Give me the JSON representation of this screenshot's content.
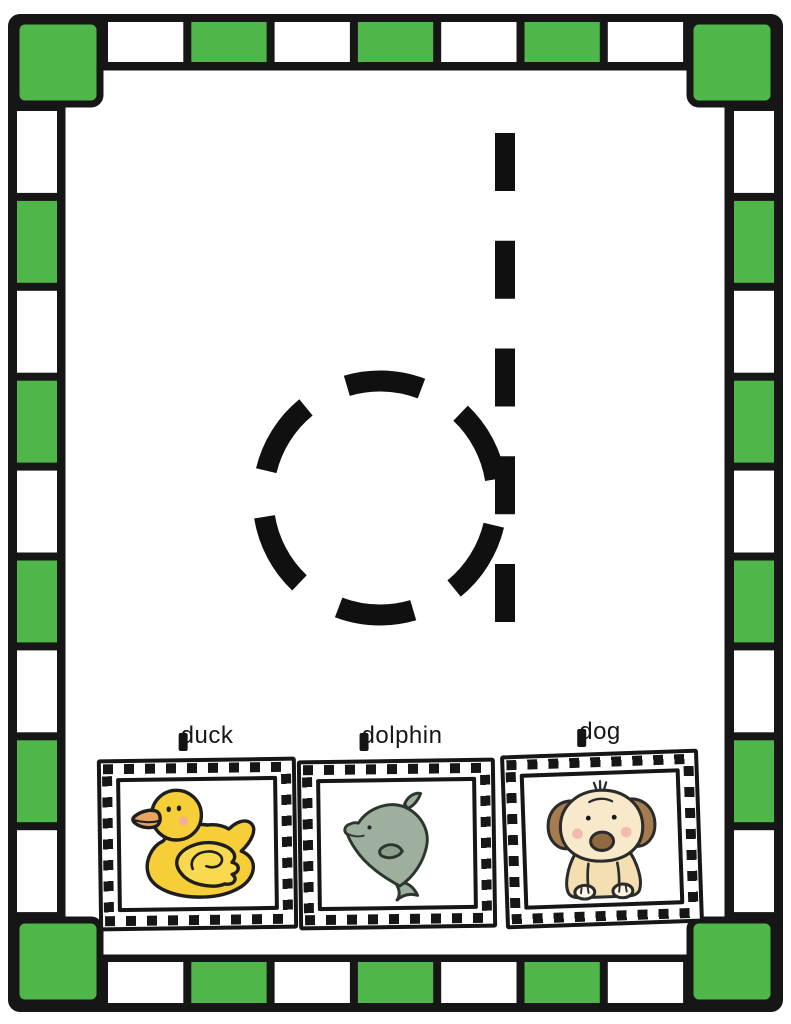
{
  "worksheet": {
    "letter": "d",
    "letter_case": "lowercase",
    "letter_style": "dashed-trace"
  },
  "colors": {
    "border_green": "#4fb74a",
    "border_white": "#ffffff",
    "frame_black": "#161616",
    "letter_black": "#101010",
    "duck_yellow": "#f6ce37",
    "duck_wing_yellow": "#f8d94f",
    "duck_bill_orange": "#e8a560",
    "dolphin_gray_green": "#9eb09d",
    "dolphin_fin": "#8ba18a",
    "dog_cream": "#f8e9ca",
    "dog_body_cream": "#f4dfb2",
    "dog_ear_brown": "#a47c50",
    "dog_nose_brown": "#8f6940",
    "dog_paw_cream": "#fcf4e3",
    "cheek_pink": "#f2aaa5"
  },
  "cards": [
    {
      "label": "duck",
      "image": "yellow-rubber-duck"
    },
    {
      "label": "dolphin",
      "image": "gray-green-dolphin"
    },
    {
      "label": "dog",
      "image": "cream-puppy-dog"
    }
  ]
}
